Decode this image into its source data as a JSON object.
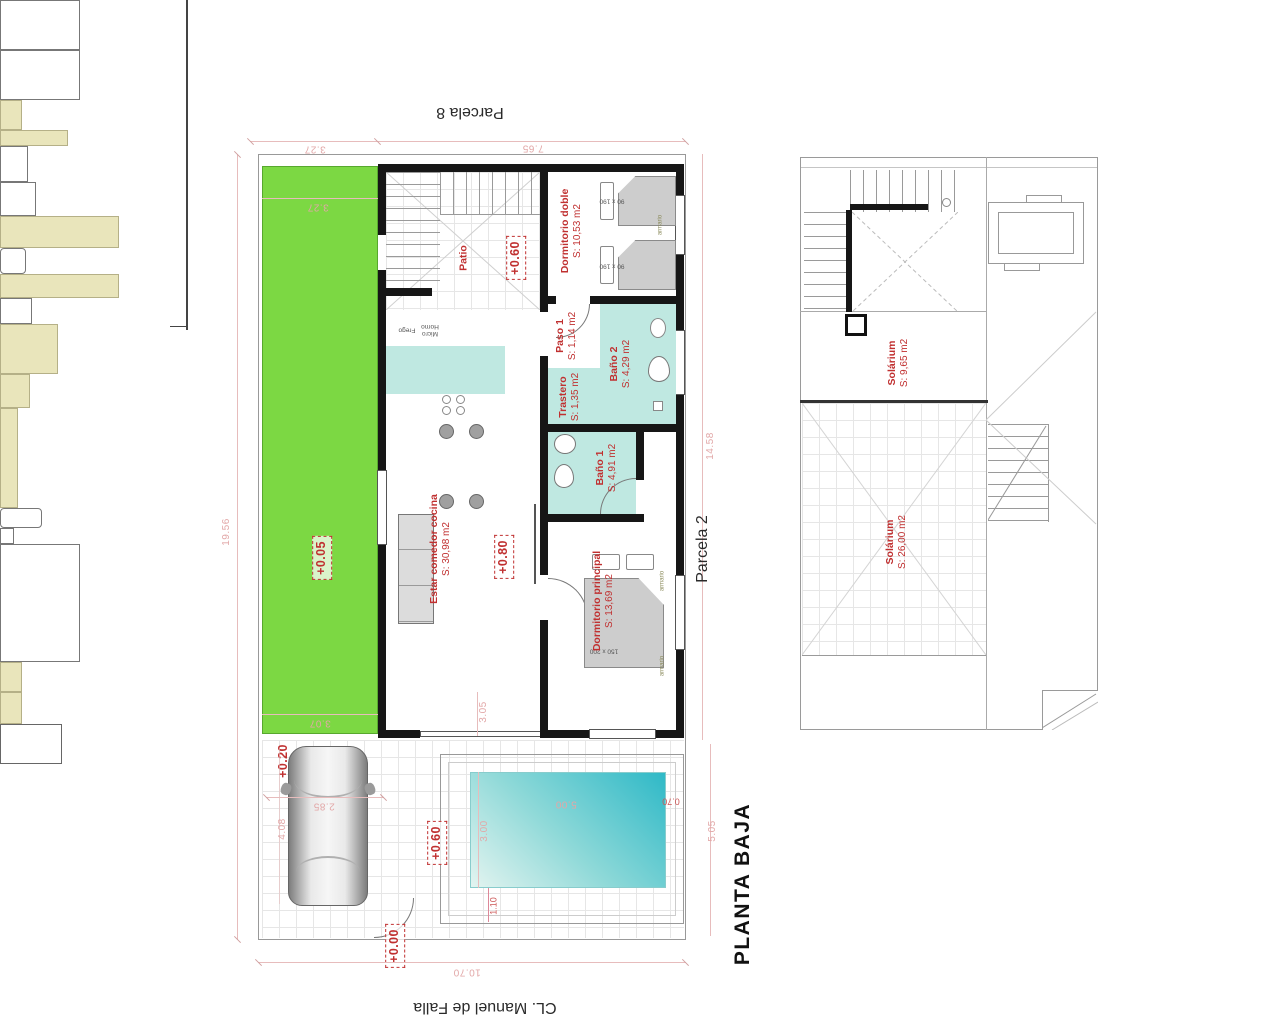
{
  "plan": {
    "title": "PLANTA BAJA",
    "street": "CL. Manuel de Falla",
    "parcel_top": "Parcela 8",
    "parcel_right": "Parcela 2"
  },
  "rooms": {
    "patio": {
      "name": "Patio"
    },
    "dormitorio_doble": {
      "name": "Dormitorio doble",
      "area": "S: 10,53 m2"
    },
    "paso_1": {
      "name": "Paso 1",
      "area": "S: 1,14 m2"
    },
    "bano_2": {
      "name": "Baño 2",
      "area": "S: 4,29 m2"
    },
    "trastero": {
      "name": "Trastero",
      "area": "S: 1,35 m2"
    },
    "bano_1": {
      "name": "Baño 1",
      "area": "S: 4,91 m2"
    },
    "estar": {
      "name": "Estar comedor cocina",
      "area": "S: 30,98 m2"
    },
    "dormitorio_principal": {
      "name": "Dormitorio principal",
      "area": "S: 13,69 m2"
    },
    "solarium_1": {
      "name": "Solárium",
      "area": "S: 9,65 m2"
    },
    "solarium_2": {
      "name": "Solárium",
      "area": "S: 26,00 m2"
    }
  },
  "levels": {
    "garden": "+0.05",
    "patio": "+0.60",
    "living": "+0.80",
    "parking": "+0.20",
    "terrace": "+0.60",
    "entrance": "+0.00"
  },
  "dims": {
    "top_left": "3.27",
    "top_right": "7.65",
    "green_width": "3.27",
    "green_bottom": "3.07",
    "left_height": "19.56",
    "right_height": "14.58",
    "terrace_height": "5.05",
    "bottom_width": "10.70",
    "car_width": "2.85",
    "car_depth": "4.08",
    "pool_width": "5.00",
    "pool_height": "3.00",
    "pool_edge": "0.70",
    "pool_offset": "1.10",
    "terrace_door": "3.05"
  },
  "fixtures": {
    "sink_cabinet": "Frego",
    "micro": "Micro",
    "horno": "Horno",
    "bed_double_size": "90 x 190",
    "bed_main_size": "150 x 200",
    "wardrobe": "armario"
  },
  "colors": {
    "garden": "#7cd843",
    "wet_rooms": "#bfe8e1",
    "pool": "#2fb9c7",
    "furniture": "#e9e5bb",
    "labels": "#c03030",
    "dimensions": "#e2a7a7"
  }
}
